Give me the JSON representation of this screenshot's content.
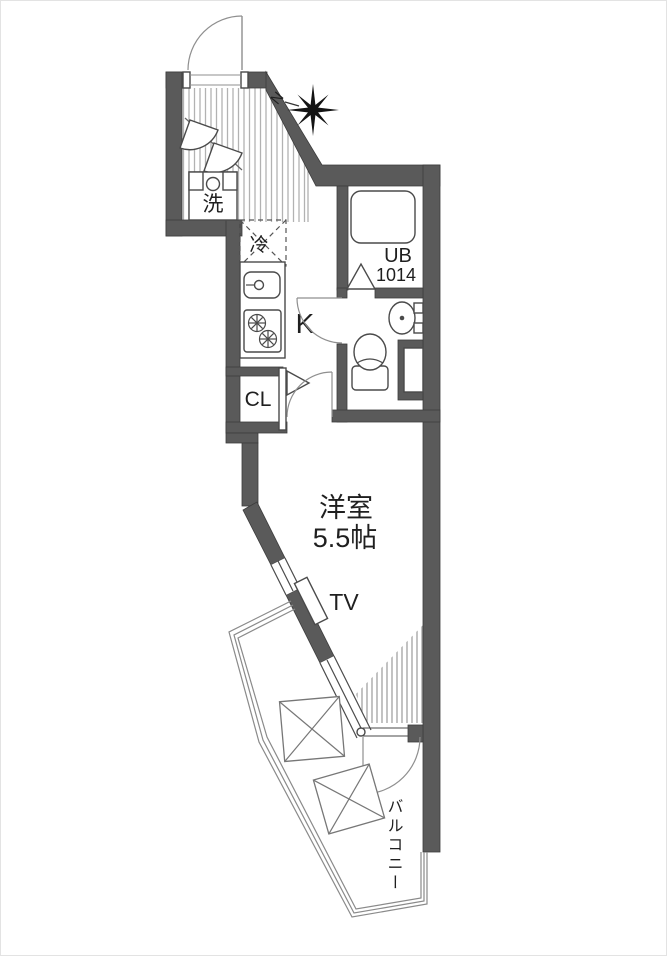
{
  "plan": {
    "rooms": {
      "main_room": {
        "label": "洋室",
        "size": "5.5帖"
      },
      "kitchen": {
        "label": "K"
      },
      "bath": {
        "label": "UB",
        "size": "1014"
      },
      "closet": {
        "label": "CL"
      },
      "washer": {
        "label": "洗"
      },
      "fridge": {
        "label": "冷"
      },
      "tv": {
        "label": "TV"
      },
      "balcony": {
        "label": "バルコニー"
      }
    },
    "compass": {
      "label": "N"
    },
    "colors": {
      "wall": "#5a5a5a",
      "line": "#4a4a4a",
      "hatch": "#aeaeae",
      "text": "#1f1f1f",
      "background": "#ffffff"
    }
  }
}
